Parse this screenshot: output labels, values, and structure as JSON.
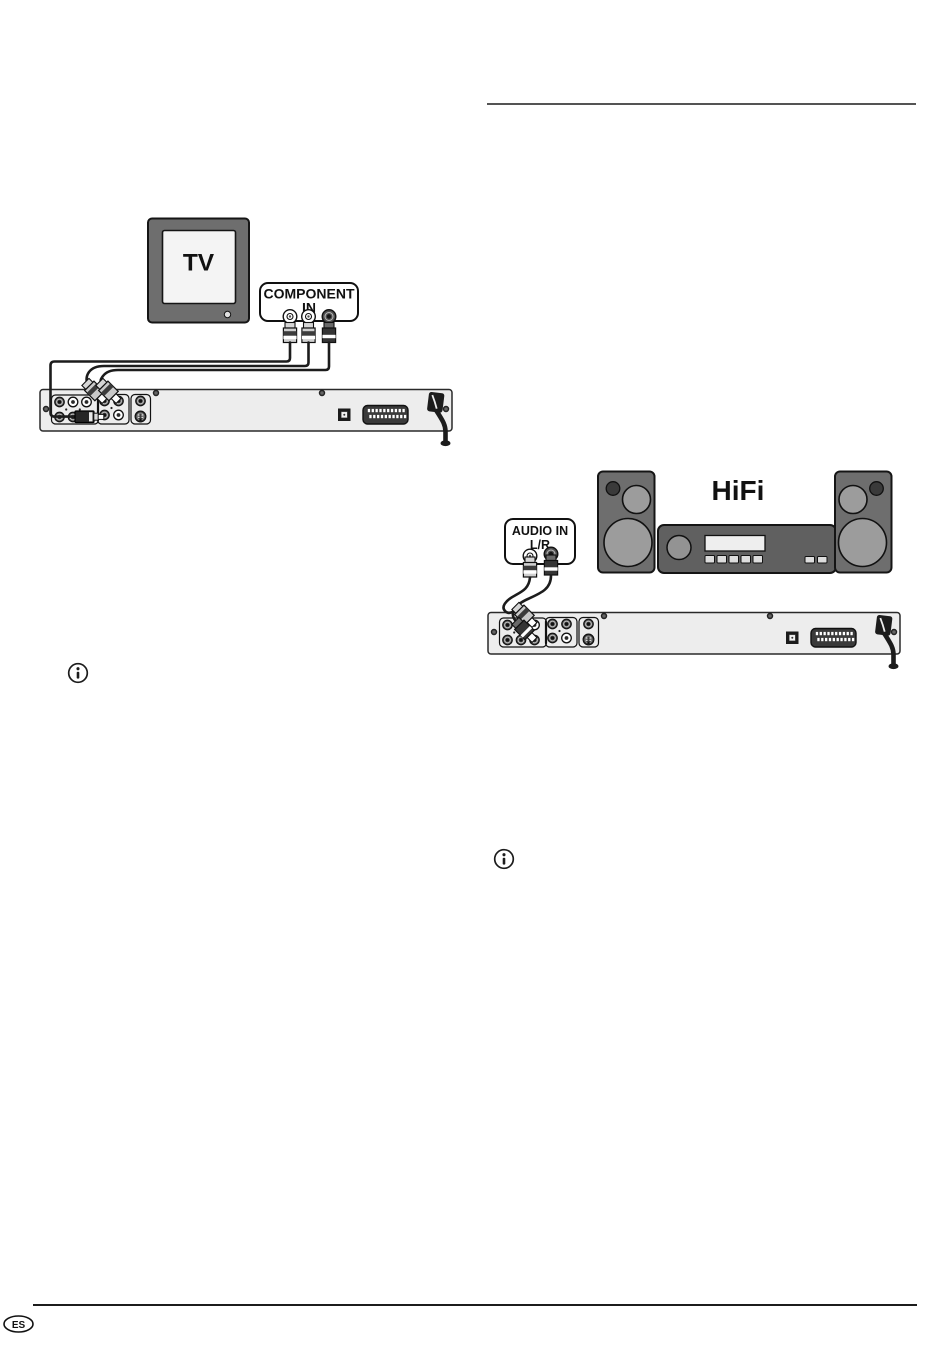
{
  "page": {
    "language_badge": "ES"
  },
  "tv_diagram": {
    "tv_label": "TV",
    "input_box_line1": "COMPONENT",
    "input_box_line2": "IN"
  },
  "hifi_diagram": {
    "hifi_label": "HiFi",
    "input_box_line1": "AUDIO IN",
    "input_box_line2": "L/R"
  }
}
